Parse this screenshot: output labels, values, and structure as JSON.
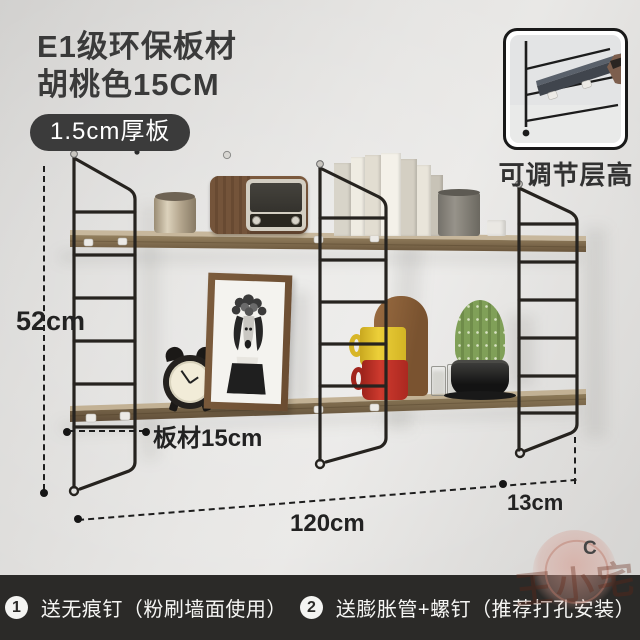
{
  "header": {
    "title_line1": "E1级环保板材",
    "title_line2": "胡桃色15CM",
    "badge": "1.5cm厚板"
  },
  "inset": {
    "caption": "可调节层高"
  },
  "dimensions": {
    "shelf_height": "52cm",
    "board_depth": "板材15cm",
    "total_width": "120cm",
    "side_gap": "13cm"
  },
  "watermark": {
    "seal_text": "王小宅",
    "corner_letter": "C"
  },
  "footer": {
    "note1_num": "1",
    "note1": "送无痕钉（粉刷墙面使用）",
    "note2_num": "2",
    "note2": "送膨胀管+螺钉（推荐打孔安装）"
  },
  "colors": {
    "badge_bg": "#3b3b3b",
    "footer_bg": "#2b2a28",
    "title_text": "#3a3a3a",
    "annotation_text": "#222222",
    "watermark_red": "#64261466",
    "frame_black": "#26231f",
    "wood_edge": "#7c694f",
    "wall_gray": "#e2e1df"
  }
}
